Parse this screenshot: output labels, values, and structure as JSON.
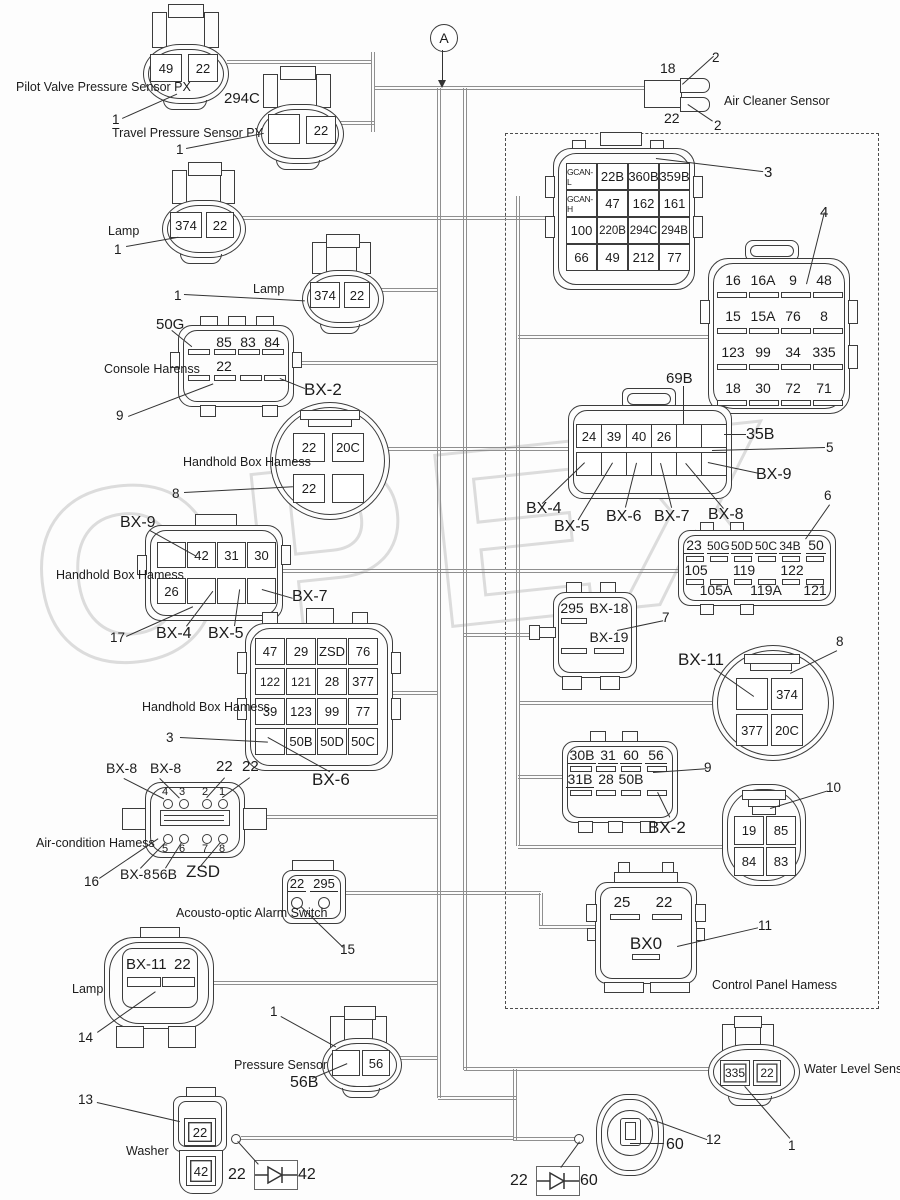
{
  "watermark": "OPEX",
  "junction_label": "A",
  "region": {
    "control_panel": "Control Panel Hamess"
  },
  "sensors": {
    "px": {
      "label": "Pilot Valve Pressure Sensor PX",
      "cells": [
        "49",
        "22"
      ],
      "ref": "1"
    },
    "py": {
      "label": "Travel Pressure Sensor PY",
      "code": "294C",
      "cell": "22",
      "ref": "1"
    },
    "air_cleaner": {
      "label": "Air Cleaner Sensor",
      "pin_top": "18",
      "pin_bottom": "22",
      "ref_top": "2",
      "ref_bottom": "2"
    },
    "lamp_a": {
      "label": "Lamp",
      "cells": [
        "374",
        "22"
      ],
      "ref": "1"
    },
    "lamp_b": {
      "label": "Lamp",
      "cells": [
        "374",
        "22"
      ],
      "ref": "1"
    },
    "lamp_c": {
      "label": "Lamp",
      "cells": [
        "BX-11",
        "22"
      ],
      "ref": "14"
    },
    "pressure": {
      "label": "Pressure Sensor",
      "code": "56B",
      "cell": "56",
      "ref": "1"
    },
    "washer": {
      "label": "Washer",
      "cells": [
        "22",
        "42"
      ],
      "ref": "13"
    },
    "water_level": {
      "label": "Water Level Sensor",
      "cells": [
        "335",
        "22"
      ],
      "ref": "1"
    },
    "round_60": {
      "label": "60",
      "ref": "12"
    },
    "alarm": {
      "label": "Acousto-optic Alarm Switch",
      "cells": [
        "22",
        "295"
      ],
      "ref": "15"
    }
  },
  "connectors": {
    "gcan": {
      "ref": "3",
      "rows": [
        [
          "GCAN-L",
          "22B",
          "360B",
          "359B"
        ],
        [
          "GCAN-H",
          "47",
          "162",
          "161"
        ],
        [
          "100",
          "220B",
          "294C",
          "294B"
        ],
        [
          "66",
          "49",
          "212",
          "77"
        ]
      ]
    },
    "c4": {
      "ref": "4",
      "rows": [
        [
          "16",
          "16A",
          "9",
          "48"
        ],
        [
          "15",
          "15A",
          "76",
          "8"
        ],
        [
          "123",
          "99",
          "34",
          "335"
        ],
        [
          "18",
          "30",
          "72",
          "71"
        ]
      ]
    },
    "console": {
      "label": "Console Harenss",
      "code": "50G",
      "tag": "BX-2",
      "ref": "9",
      "row1": [
        "85",
        "83",
        "84"
      ],
      "row2": [
        "22"
      ]
    },
    "bx2_round": {
      "label": "Handhold Box Hamess",
      "ref": "8",
      "cells": [
        "22",
        "20C",
        "22"
      ]
    },
    "bx9": {
      "label": "Handhold Box Hamess",
      "ref": "17",
      "tag_tl": "BX-9",
      "tag_r": "BX-7",
      "tag_b1": "BX-4",
      "tag_b2": "BX-5",
      "cells": [
        "42",
        "31",
        "30",
        "26"
      ]
    },
    "bx6": {
      "label": "Handhold Box Hamess",
      "ref": "3",
      "tag": "BX-6",
      "rows": [
        [
          "47",
          "29",
          "ZSD",
          "76"
        ],
        [
          "122",
          "121",
          "28",
          "377"
        ],
        [
          "39",
          "123",
          "99",
          "77"
        ],
        [
          "",
          "50B",
          "50D",
          "50C"
        ]
      ]
    },
    "b35": {
      "ref": "5",
      "top": [
        "24",
        "39",
        "40",
        "26"
      ],
      "tag_69": "69B",
      "tag_35": "35B",
      "tag_bx9": "BX-9",
      "tag_bx4": "BX-4",
      "tag_bx5": "BX-5",
      "tag_bx6": "BX-6",
      "tag_bx7": "BX-7",
      "tag_bx8": "BX-8"
    },
    "b6": {
      "ref": "6",
      "row1": [
        "23",
        "50G",
        "50D",
        "50C",
        "34B",
        "50"
      ],
      "row2": [
        "105",
        "119",
        "122"
      ],
      "row3": [
        "105A",
        "119A",
        "121"
      ]
    },
    "c7": {
      "ref": "7",
      "top": [
        "295",
        "BX-18"
      ],
      "bottom": "BX-19"
    },
    "bx11_round": {
      "ref": "8",
      "tag": "BX-11",
      "cells": [
        "374",
        "377",
        "20C"
      ]
    },
    "b9": {
      "ref": "9",
      "tag": "BX-2",
      "row1": [
        "30B",
        "31",
        "60",
        "56"
      ],
      "row2": [
        "31B",
        "28",
        "50B"
      ]
    },
    "c10": {
      "ref": "10",
      "cells": [
        "19",
        "85",
        "84",
        "83"
      ]
    },
    "aircon": {
      "label": "Air-condition Hamess",
      "ref": "16",
      "top_tags": [
        "BX-8",
        "BX-8",
        "22",
        "22"
      ],
      "top_pins": [
        "4",
        "3",
        "2",
        "1"
      ],
      "bottom_pins": [
        "5",
        "6",
        "7",
        "8"
      ],
      "bottom_tags": [
        "BX-8",
        "56B",
        "ZSD"
      ]
    },
    "bx0": {
      "ref": "11",
      "top": [
        "25",
        "22"
      ],
      "name": "BX0"
    }
  },
  "diodes": {
    "d1": {
      "left": "22",
      "right": "42"
    },
    "d2": {
      "left": "22",
      "right": "60"
    }
  }
}
